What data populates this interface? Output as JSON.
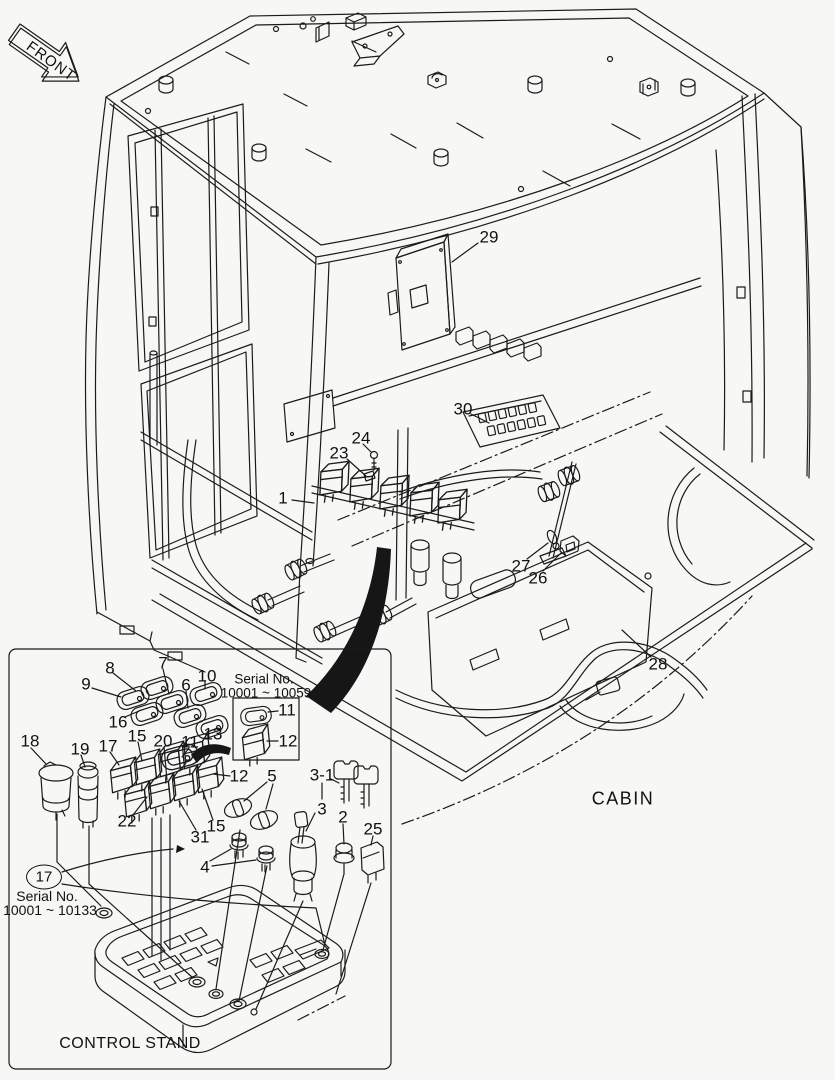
{
  "front_arrow": {
    "label": "FRONT"
  },
  "cabin": {
    "label": "CABIN",
    "callouts": [
      {
        "label": "29",
        "x": 489,
        "y": 237
      },
      {
        "label": "30",
        "x": 463,
        "y": 409
      },
      {
        "label": "24",
        "x": 361,
        "y": 438
      },
      {
        "label": "23",
        "x": 339,
        "y": 453
      },
      {
        "label": "1",
        "x": 283,
        "y": 498
      },
      {
        "label": "27",
        "x": 521,
        "y": 566
      },
      {
        "label": "26",
        "x": 538,
        "y": 578
      },
      {
        "label": "28",
        "x": 658,
        "y": 664
      }
    ]
  },
  "inset": {
    "title": "CONTROL STAND",
    "serial_box": {
      "line1": "Serial No.",
      "line2": "10001 ~ 10059"
    },
    "serial_note": {
      "circled_label": "17",
      "line1": "Serial No.",
      "line2": "10001 ~ 10133"
    },
    "callouts": [
      {
        "label": "8",
        "x": 110,
        "y": 668
      },
      {
        "label": "7",
        "x": 163,
        "y": 663
      },
      {
        "label": "9",
        "x": 86,
        "y": 684
      },
      {
        "label": "6",
        "x": 186,
        "y": 685
      },
      {
        "label": "10",
        "x": 207,
        "y": 676
      },
      {
        "label": "16",
        "x": 118,
        "y": 722
      },
      {
        "label": "13",
        "x": 213,
        "y": 734
      },
      {
        "label": "11",
        "x": 287,
        "y": 710
      },
      {
        "label": "12",
        "x": 288,
        "y": 741
      },
      {
        "label": "18",
        "x": 30,
        "y": 741
      },
      {
        "label": "19",
        "x": 80,
        "y": 749
      },
      {
        "label": "17",
        "x": 108,
        "y": 746
      },
      {
        "label": "15",
        "x": 137,
        "y": 736
      },
      {
        "label": "20",
        "x": 163,
        "y": 741
      },
      {
        "label": "11",
        "x": 190,
        "y": 742
      },
      {
        "label": "12",
        "x": 239,
        "y": 776
      },
      {
        "label": "5",
        "x": 272,
        "y": 776
      },
      {
        "label": "3-1",
        "x": 322,
        "y": 775
      },
      {
        "label": "3",
        "x": 322,
        "y": 809
      },
      {
        "label": "2",
        "x": 343,
        "y": 817
      },
      {
        "label": "25",
        "x": 373,
        "y": 829
      },
      {
        "label": "22",
        "x": 127,
        "y": 821
      },
      {
        "label": "31",
        "x": 200,
        "y": 837
      },
      {
        "label": "15",
        "x": 216,
        "y": 826
      },
      {
        "label": "4",
        "x": 205,
        "y": 867
      }
    ]
  }
}
